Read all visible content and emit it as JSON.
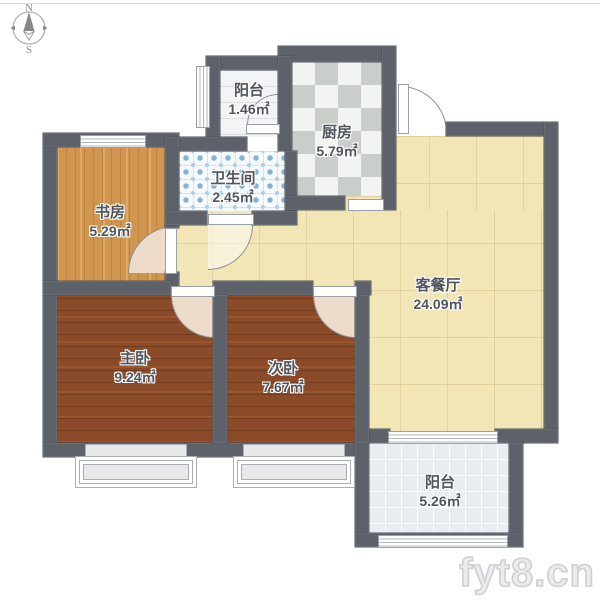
{
  "plan": {
    "compass": {
      "north": "N",
      "south": "S"
    },
    "watermark": "fyt8.cn",
    "rooms": [
      {
        "id": "balcony-north",
        "name": "阳台",
        "area": "1.46㎡"
      },
      {
        "id": "kitchen",
        "name": "厨房",
        "area": "5.79㎡"
      },
      {
        "id": "bathroom",
        "name": "卫生间",
        "area": "2.45㎡"
      },
      {
        "id": "study",
        "name": "书房",
        "area": "5.29㎡"
      },
      {
        "id": "living-dining",
        "name": "客餐厅",
        "area": "24.09㎡"
      },
      {
        "id": "master-bedroom",
        "name": "主卧",
        "area": "9.24㎡"
      },
      {
        "id": "second-bedroom",
        "name": "次卧",
        "area": "7.67㎡"
      },
      {
        "id": "balcony-south",
        "name": "阳台",
        "area": "5.26㎡"
      }
    ],
    "colors": {
      "wall": "#5d626a",
      "study_floor": "#d0964f",
      "bedroom_floor": "#8b4b28",
      "living_floor": "#f2e5b6",
      "kitchen_tile_dark": "#caceca",
      "kitchen_tile_light": "#f2f4f1",
      "bathroom_tile": "#f6f9fb",
      "bathroom_dot": "#84b3d6",
      "balcony_north_floor": "#f3f4f6",
      "balcony_south_floor": "#e9edf2",
      "door_swing": "#eddbcb",
      "label_text": "#4f555d",
      "watermark_gray": "#cfcfd4"
    }
  }
}
